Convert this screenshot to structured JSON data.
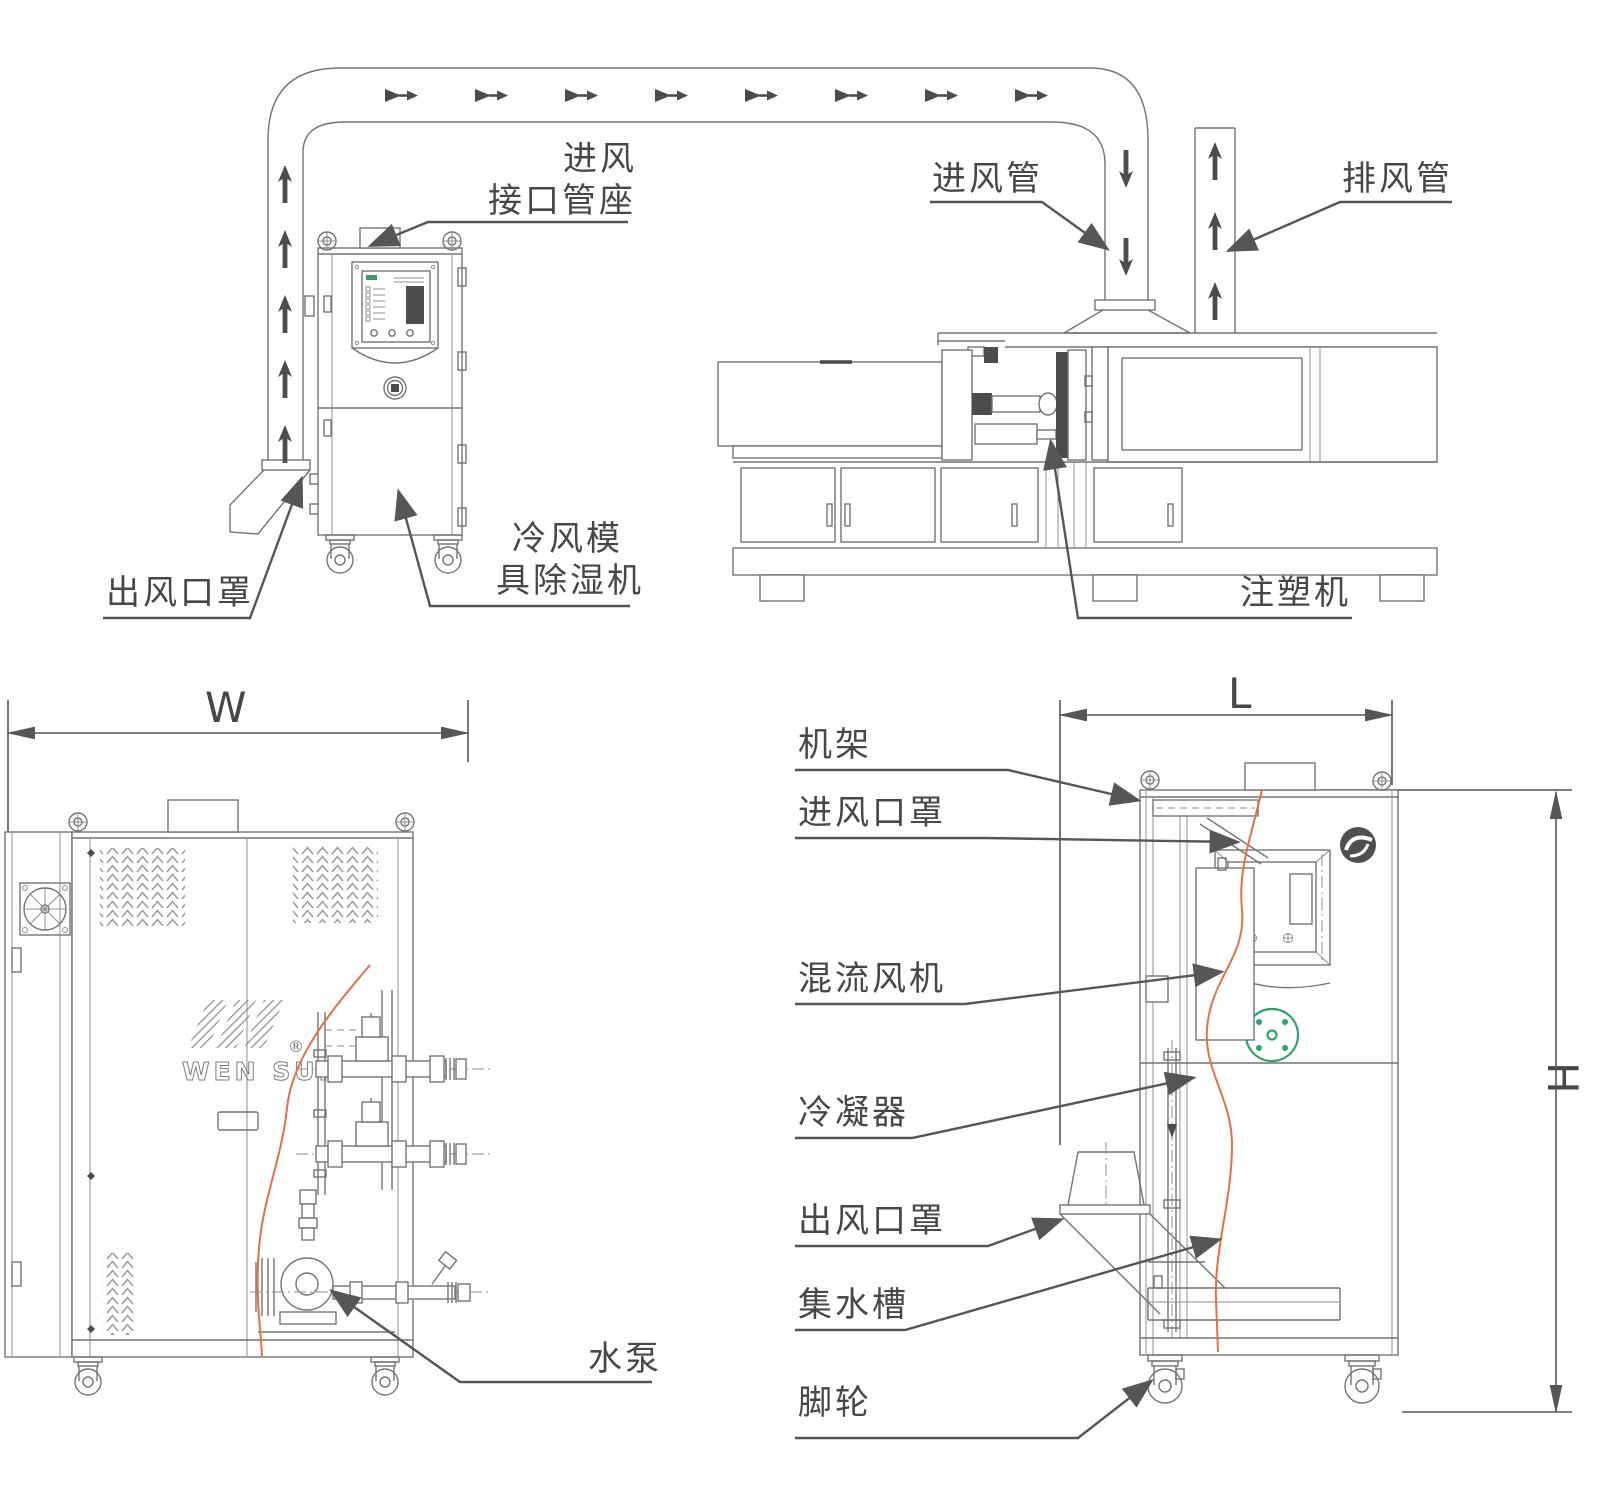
{
  "colors": {
    "line": "#747474",
    "leader": "#565656",
    "section_cut_orange": "#e2714a",
    "accent_green": "#2fa36c"
  },
  "top_view": {
    "labels": {
      "intake_air": "进风",
      "intake_socket": "接口管座",
      "intake_pipe": "进风管",
      "exhaust_pipe": "排风管",
      "outlet_cover": "出风口罩",
      "dehumidifier_line1": "冷风模",
      "dehumidifier_line2": "具除湿机",
      "injection_machine": "注塑机"
    }
  },
  "front_view": {
    "labels": {
      "width_dim": "W",
      "water_pump": "水泵"
    },
    "brand": {
      "name": "WEN SUI",
      "registered": "®"
    }
  },
  "side_view": {
    "labels": {
      "length_dim": "L",
      "height_dim": "H",
      "frame": "机架",
      "inlet_cover": "进风口罩",
      "mixed_flow_fan": "混流风机",
      "condenser": "冷凝器",
      "outlet_cover": "出风口罩",
      "water_tank": "集水槽",
      "caster": "脚轮"
    }
  }
}
